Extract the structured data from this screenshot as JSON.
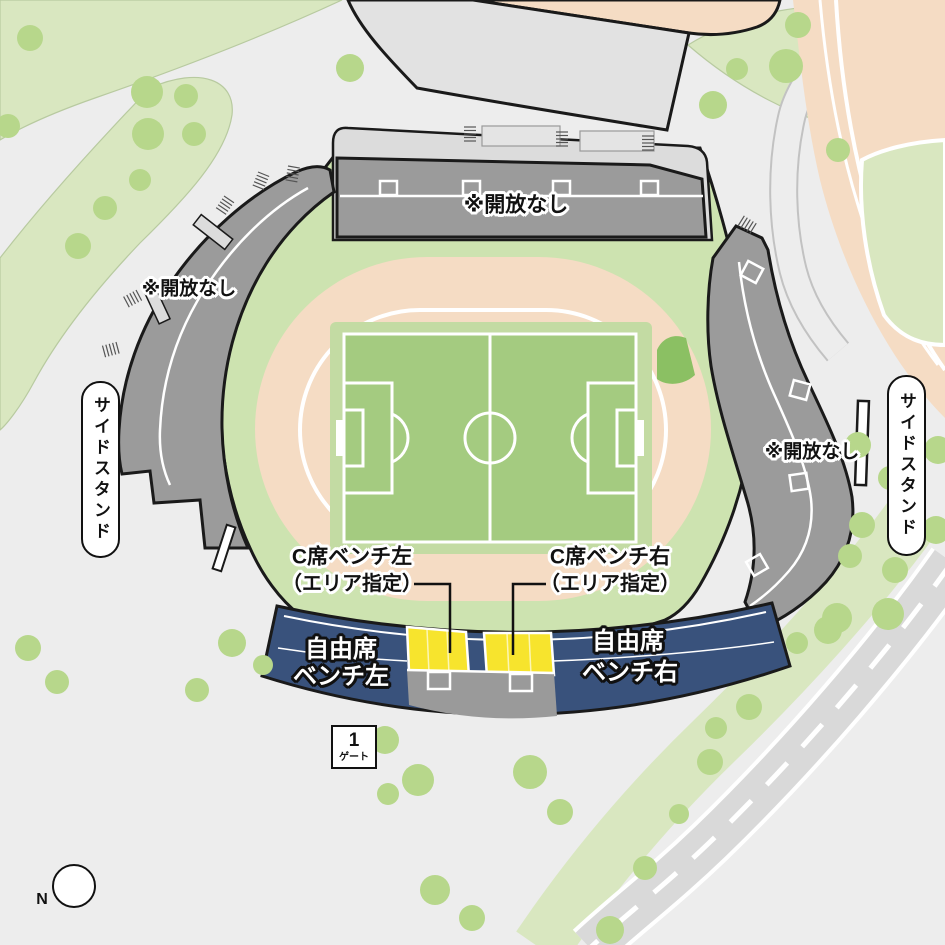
{
  "map_title": "スタジアム座席マップ",
  "stands": {
    "north_closed_label": "※開放なし",
    "west_closed_label": "※開放なし",
    "east_closed_label": "※開放なし",
    "side_stand_left_label": "サイドスタンド",
    "side_stand_right_label": "サイドスタンド"
  },
  "sections": {
    "c_seat_left_line1": "C席ベンチ左",
    "c_seat_left_line2": "（エリア指定）",
    "c_seat_right_line1": "C席ベンチ右",
    "c_seat_right_line2": "（エリア指定）",
    "free_seat_left_line1": "自由席",
    "free_seat_left_line2": "ベンチ左",
    "free_seat_right_line1": "自由席",
    "free_seat_right_line2": "ベンチ右"
  },
  "gate": {
    "number": "1",
    "label": "ゲート"
  },
  "compass": {
    "label": "N"
  },
  "colors": {
    "background": "#ededed",
    "greenery": "#d9e7c0",
    "tree": "#b7d78b",
    "stadium_ground": "#cde3b0",
    "track": "#f5dcc4",
    "field": "#a4cb80",
    "field_border": "#c3dba3",
    "wedge_green": "#8bc063",
    "closed_stand_gray": "#9b9b9b",
    "building_gray": "#e2e2e2",
    "free_seat_navy": "#39527c",
    "c_seat_yellow": "#f7e42d",
    "road_gray": "#d9d9d9",
    "outline_black": "#1a1a1a"
  }
}
